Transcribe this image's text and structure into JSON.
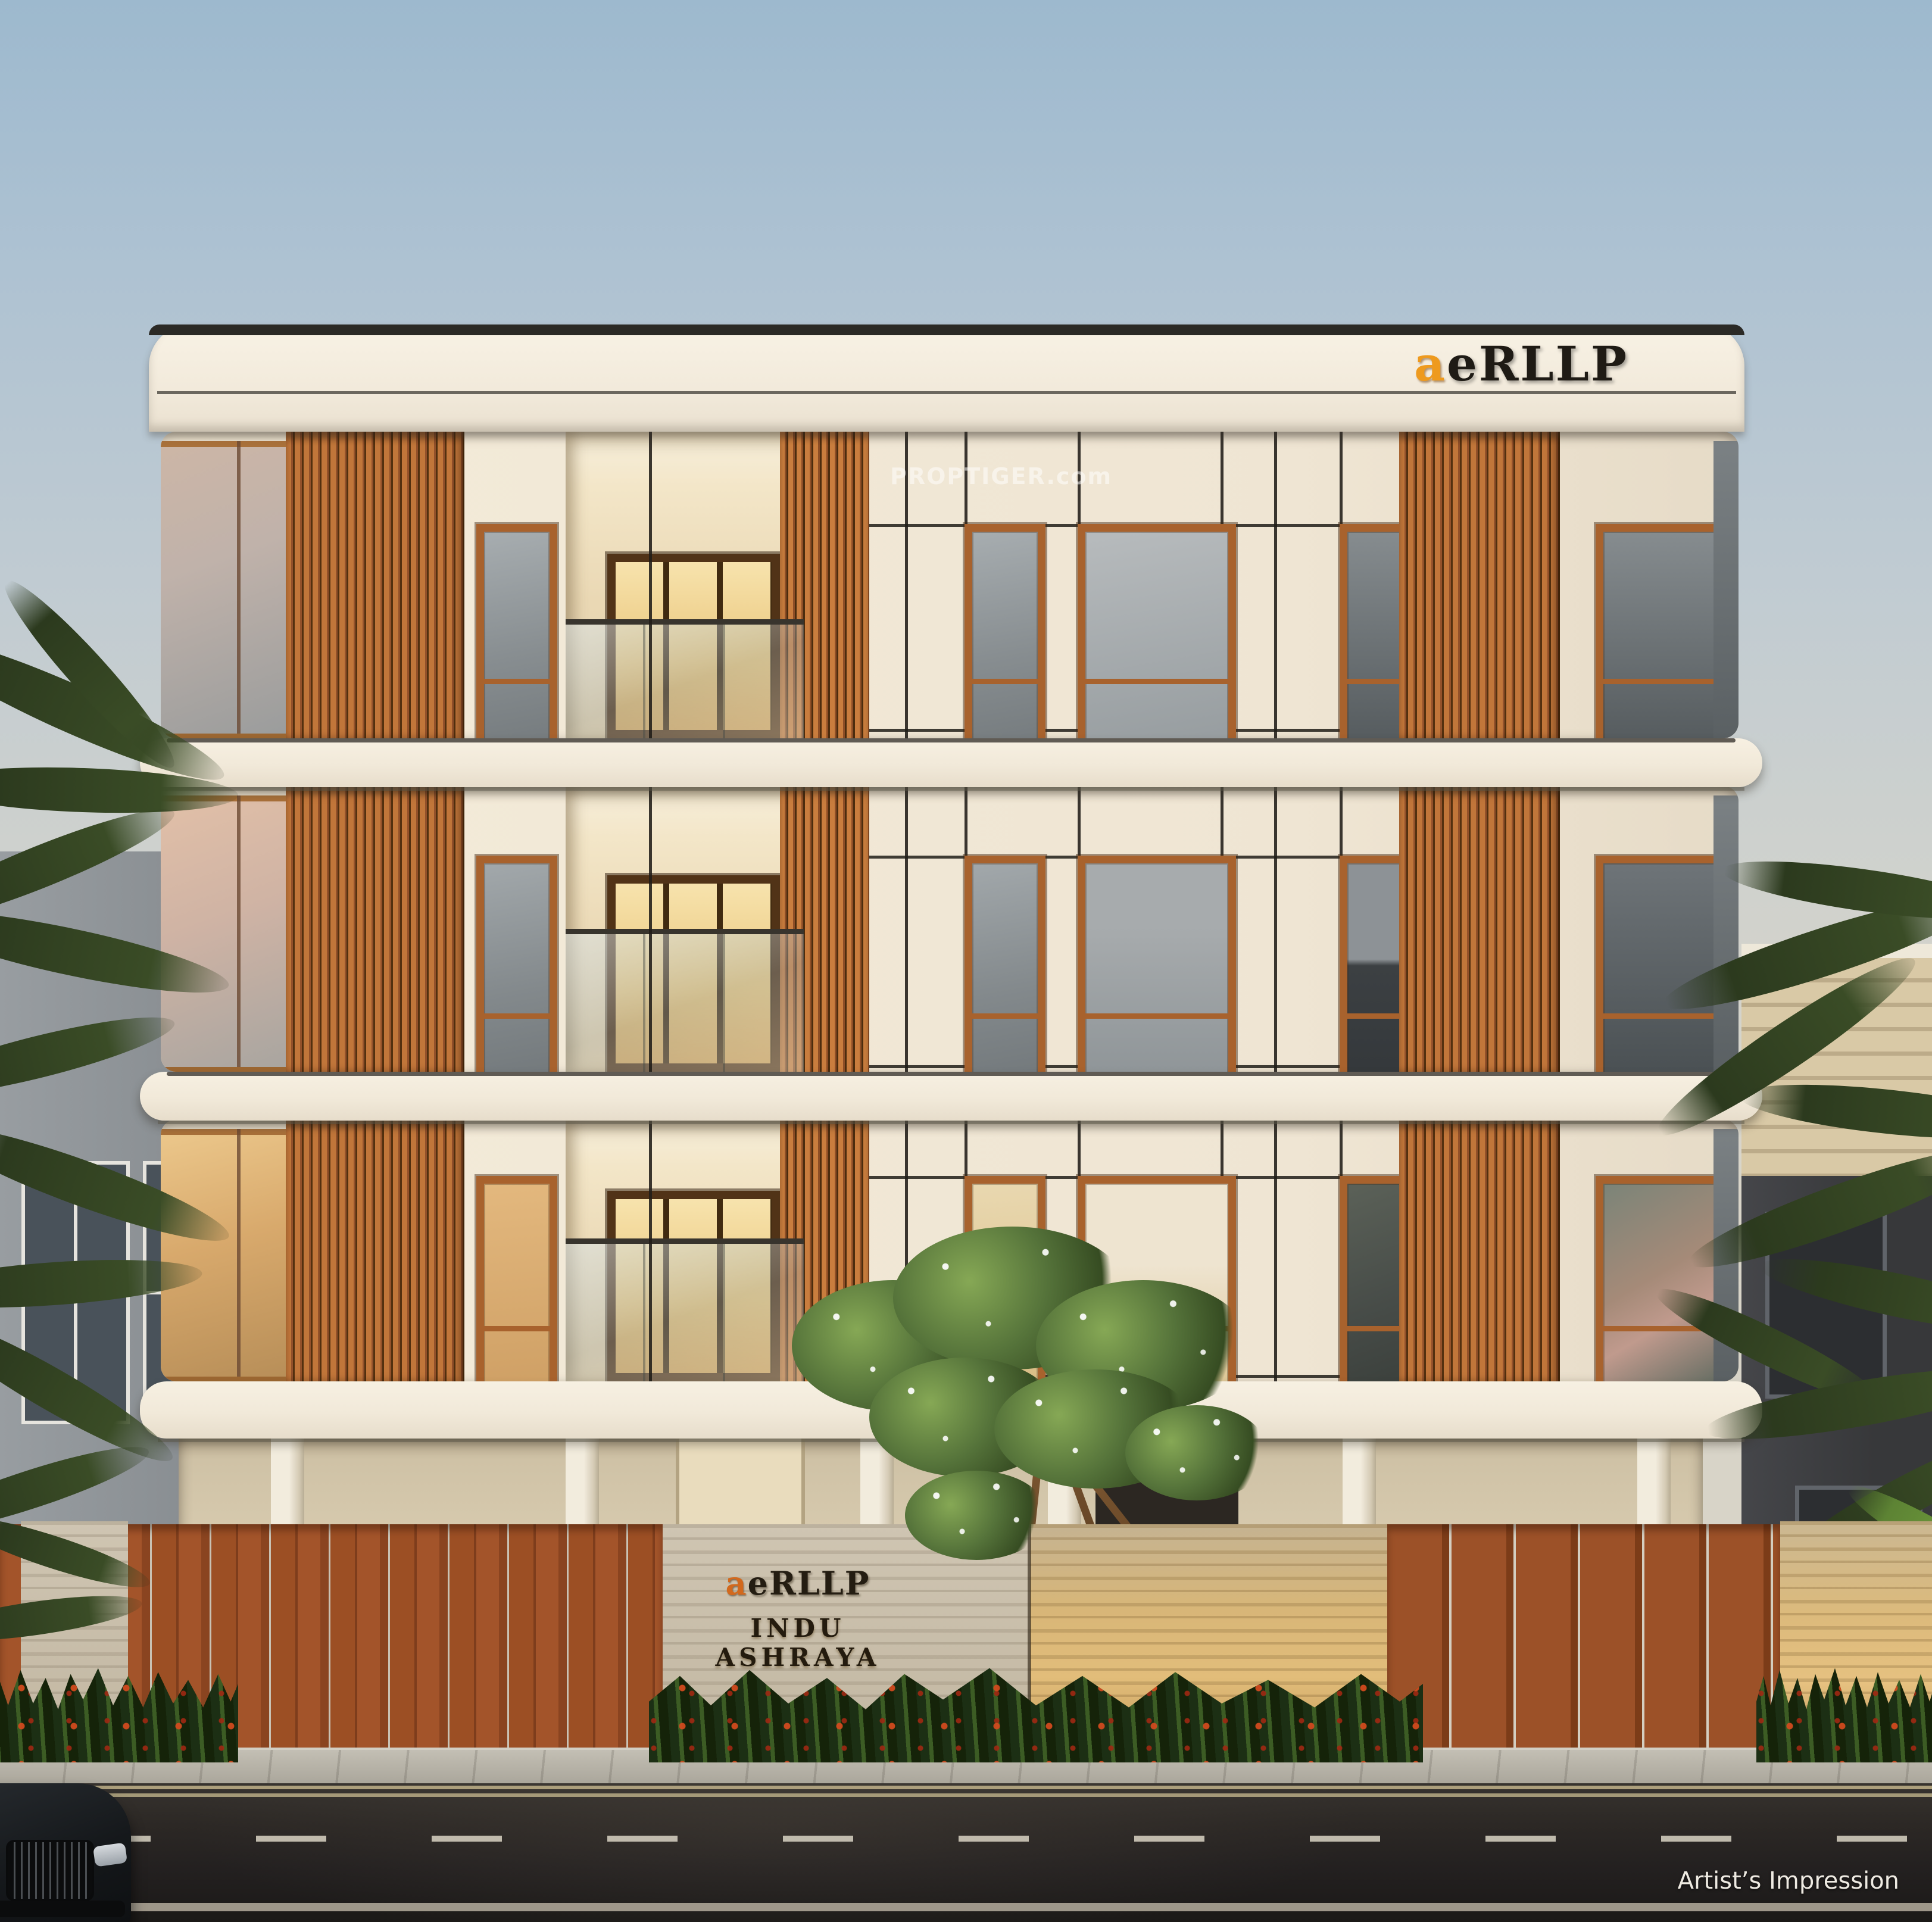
{
  "meta": {
    "image_type": "architectural-render",
    "subject": "Three-storey residential building front elevation at dusk with stilt parking, wooden slat screens, gated compound wall and street"
  },
  "branding": {
    "logo_prefix": "a",
    "logo_suffix": "eRLLP",
    "logo_prefix_color": "#ee9a1e",
    "logo_suffix_color": "#1f1b15"
  },
  "signage": {
    "logo_prefix": "a",
    "logo_suffix": "eRLLP",
    "project_name": "INDU ASHRAYA"
  },
  "watermark": {
    "text": "PROPTIGER.com"
  },
  "caption": {
    "text": "Artist’s Impression"
  },
  "counts": {
    "floors_visible": 3,
    "slat_screen_columns": 2
  },
  "palette": {
    "sky_top": "#9db9ce",
    "sky_horizon": "#d9d5c9",
    "facade_cream": "#f2e9d7",
    "parapet_trim_dark": "#2b2a26",
    "wood_slat": "#b5672f",
    "wood_window_frame": "#a8622d",
    "glass_grey": "#8d9396",
    "glass_warm_lit": "#eed9a4",
    "travertine_light": "#c7bcaa",
    "travertine_lit_gold": "#ddb97c",
    "fence_wood": "#9c5128",
    "foliage_dark": "#31421f",
    "foliage_bright": "#6f9a3d",
    "shrub_flower_red": "#c14a22",
    "sidewalk_grey": "#b6b2a7",
    "asphalt_dark": "#2a2623",
    "road_marking": "#d0cabb",
    "car_body_dark": "#15171a"
  }
}
